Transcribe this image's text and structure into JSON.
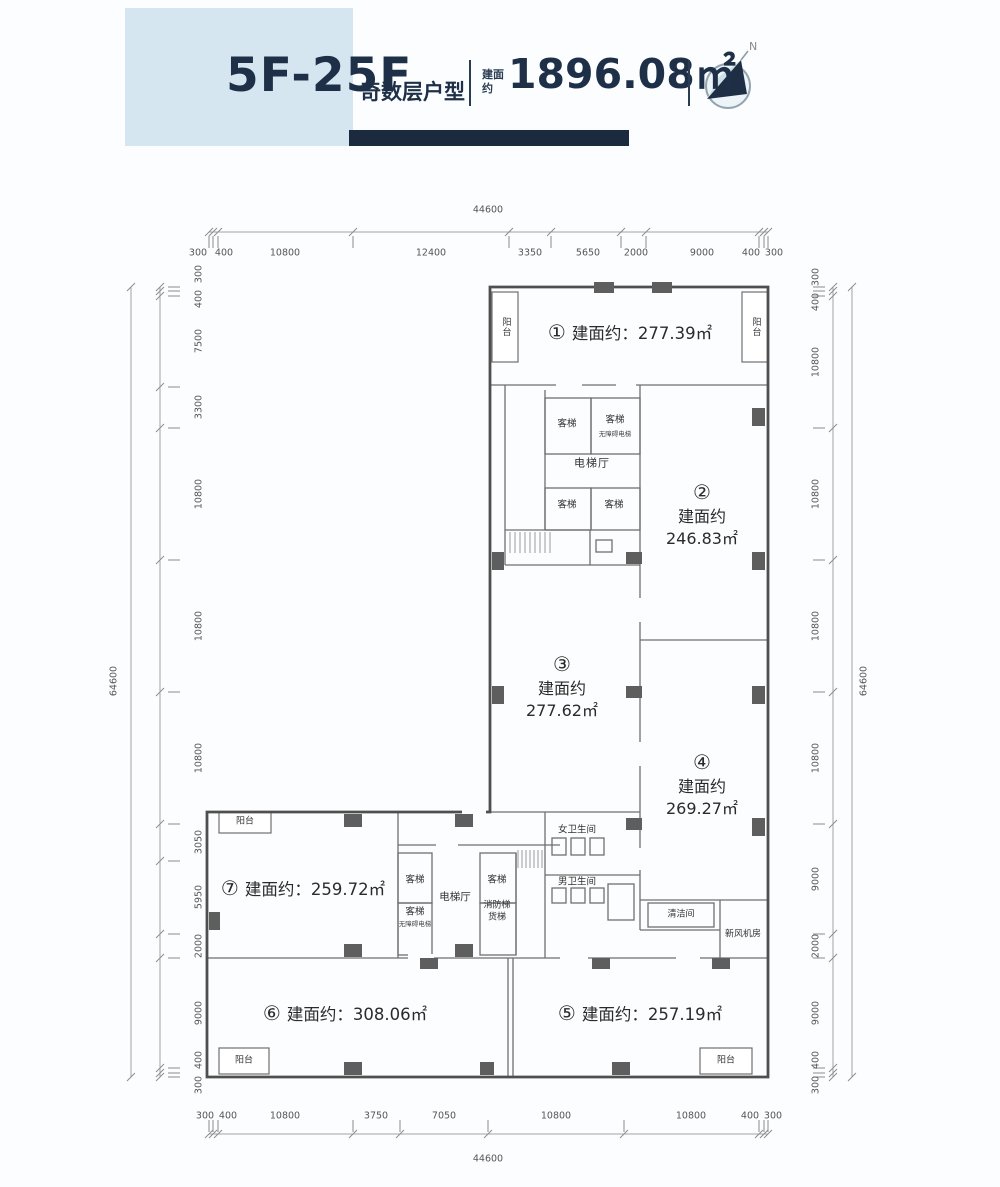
{
  "header": {
    "title": "5F-25F",
    "subtitle": "奇数层户型",
    "area_prefix": "建面约",
    "total_area": "1896.08㎡",
    "compass_label": "N"
  },
  "colors": {
    "accent": "#1b2a3e",
    "panel": "#d5e6f0",
    "wall": "#4f4f4f"
  },
  "units": [
    {
      "no": "①",
      "prefix": "建面约：",
      "area": "277.39㎡"
    },
    {
      "no": "②",
      "prefix": "建面约",
      "area": "246.83㎡"
    },
    {
      "no": "③",
      "prefix": "建面约",
      "area": "277.62㎡"
    },
    {
      "no": "④",
      "prefix": "建面约",
      "area": "269.27㎡"
    },
    {
      "no": "⑤",
      "prefix": "建面约：",
      "area": "257.19㎡"
    },
    {
      "no": "⑥",
      "prefix": "建面约：",
      "area": "308.06㎡"
    },
    {
      "no": "⑦",
      "prefix": "建面约：",
      "area": "259.72㎡"
    }
  ],
  "rooms": {
    "passenger_lift": "客梯",
    "barrier_free_lift": "无障碍电梯",
    "lift_lobby": "电梯厅",
    "fire_lift": "消防梯",
    "freight_lift": "货梯",
    "womens_wc": "女卫生间",
    "mens_wc": "男卫生间",
    "cleaning_room": "清洁间",
    "fresh_air_room": "新风机房",
    "balcony": "阳台"
  },
  "dims": {
    "top": {
      "total": "44600",
      "segments": [
        "300",
        "400",
        "10800",
        "12400",
        "3350",
        "5650",
        "2000",
        "9000",
        "400",
        "300"
      ]
    },
    "bottom": {
      "total": "44600",
      "segments": [
        "300",
        "400",
        "10800",
        "3750",
        "7050",
        "10800",
        "10800",
        "400",
        "300"
      ]
    },
    "left": {
      "total": "64600",
      "segments": [
        "300",
        "400",
        "7500",
        "3300",
        "10800",
        "10800",
        "10800",
        "3050",
        "5950",
        "2000",
        "9000",
        "400",
        "300"
      ]
    },
    "right": {
      "total": "64600",
      "segments": [
        "300",
        "400",
        "10800",
        "10800",
        "10800",
        "10800",
        "9000",
        "2000",
        "9000",
        "400",
        "300"
      ]
    }
  }
}
